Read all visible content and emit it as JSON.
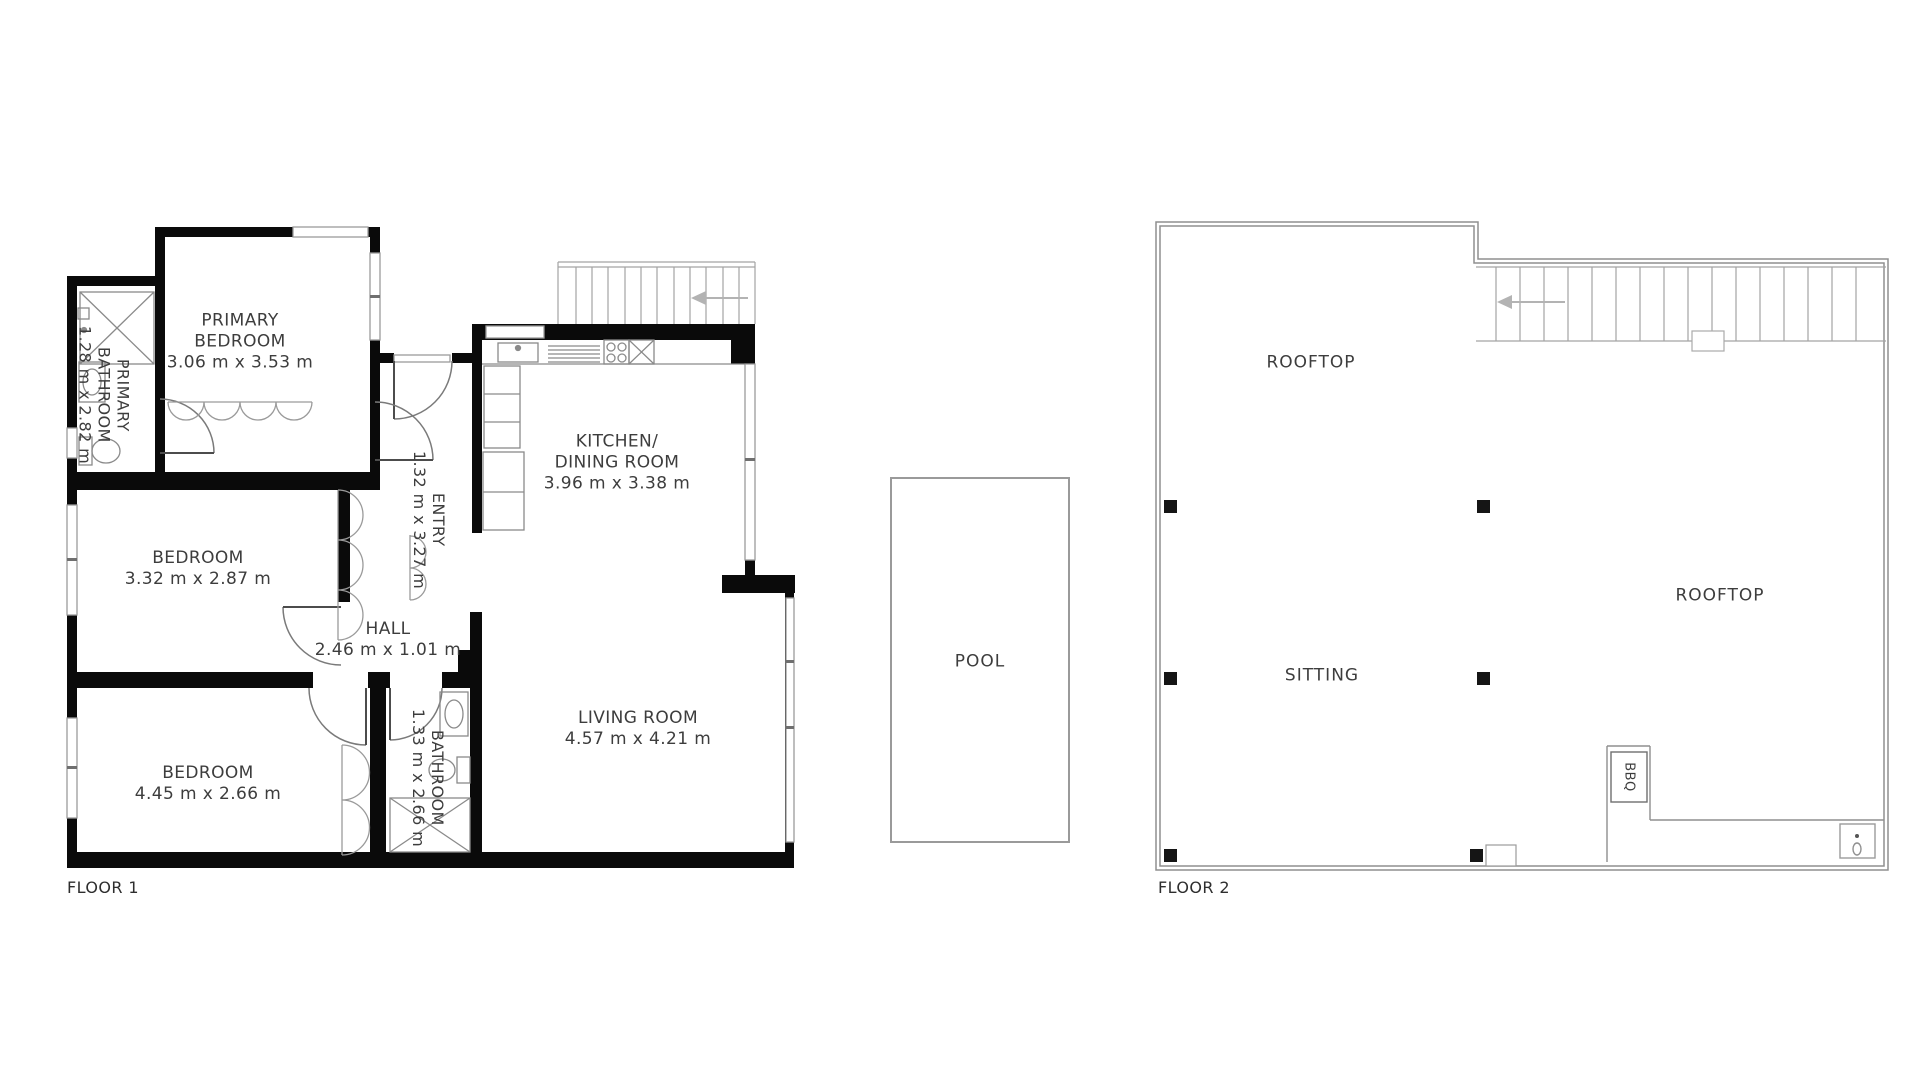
{
  "floor1": {
    "label": "FLOOR 1",
    "rooms": {
      "primary_bedroom": {
        "line1": "PRIMARY",
        "line2": "BEDROOM",
        "dims": "3.06 m x 3.53 m"
      },
      "primary_bathroom": {
        "line1": "PRIMARY",
        "line2": "BATHROOM",
        "dims": "1.28 m x 2.82 m"
      },
      "entry": {
        "line1": "ENTRY",
        "dims": "1.32 m x 3.27 m"
      },
      "kitchen_dining": {
        "line1": "KITCHEN/",
        "line2": "DINING ROOM",
        "dims": "3.96 m x 3.38 m"
      },
      "bedroom_middle": {
        "line1": "BEDROOM",
        "dims": "3.32 m x 2.87 m"
      },
      "hall": {
        "line1": "HALL",
        "dims": "2.46 m x 1.01 m"
      },
      "bedroom_bottom": {
        "line1": "BEDROOM",
        "dims": "4.45 m x 2.66 m"
      },
      "bathroom": {
        "line1": "BATHROOM",
        "dims": "1.33 m x 2.66 m"
      },
      "living_room": {
        "line1": "LIVING ROOM",
        "dims": "4.57 m x 4.21 m"
      }
    }
  },
  "floor2": {
    "label": "FLOOR 2",
    "areas": {
      "rooftop_top": "ROOFTOP",
      "rooftop_right": "ROOFTOP",
      "sitting": "SITTING",
      "bbq": "BBQ"
    }
  },
  "pool": {
    "label": "POOL"
  },
  "colors": {
    "wall": "#0a0a0a",
    "thin_wall": "#8f8f8f",
    "fixture": "#8a8a8a",
    "text": "#3d3d3d",
    "background": "#ffffff"
  }
}
